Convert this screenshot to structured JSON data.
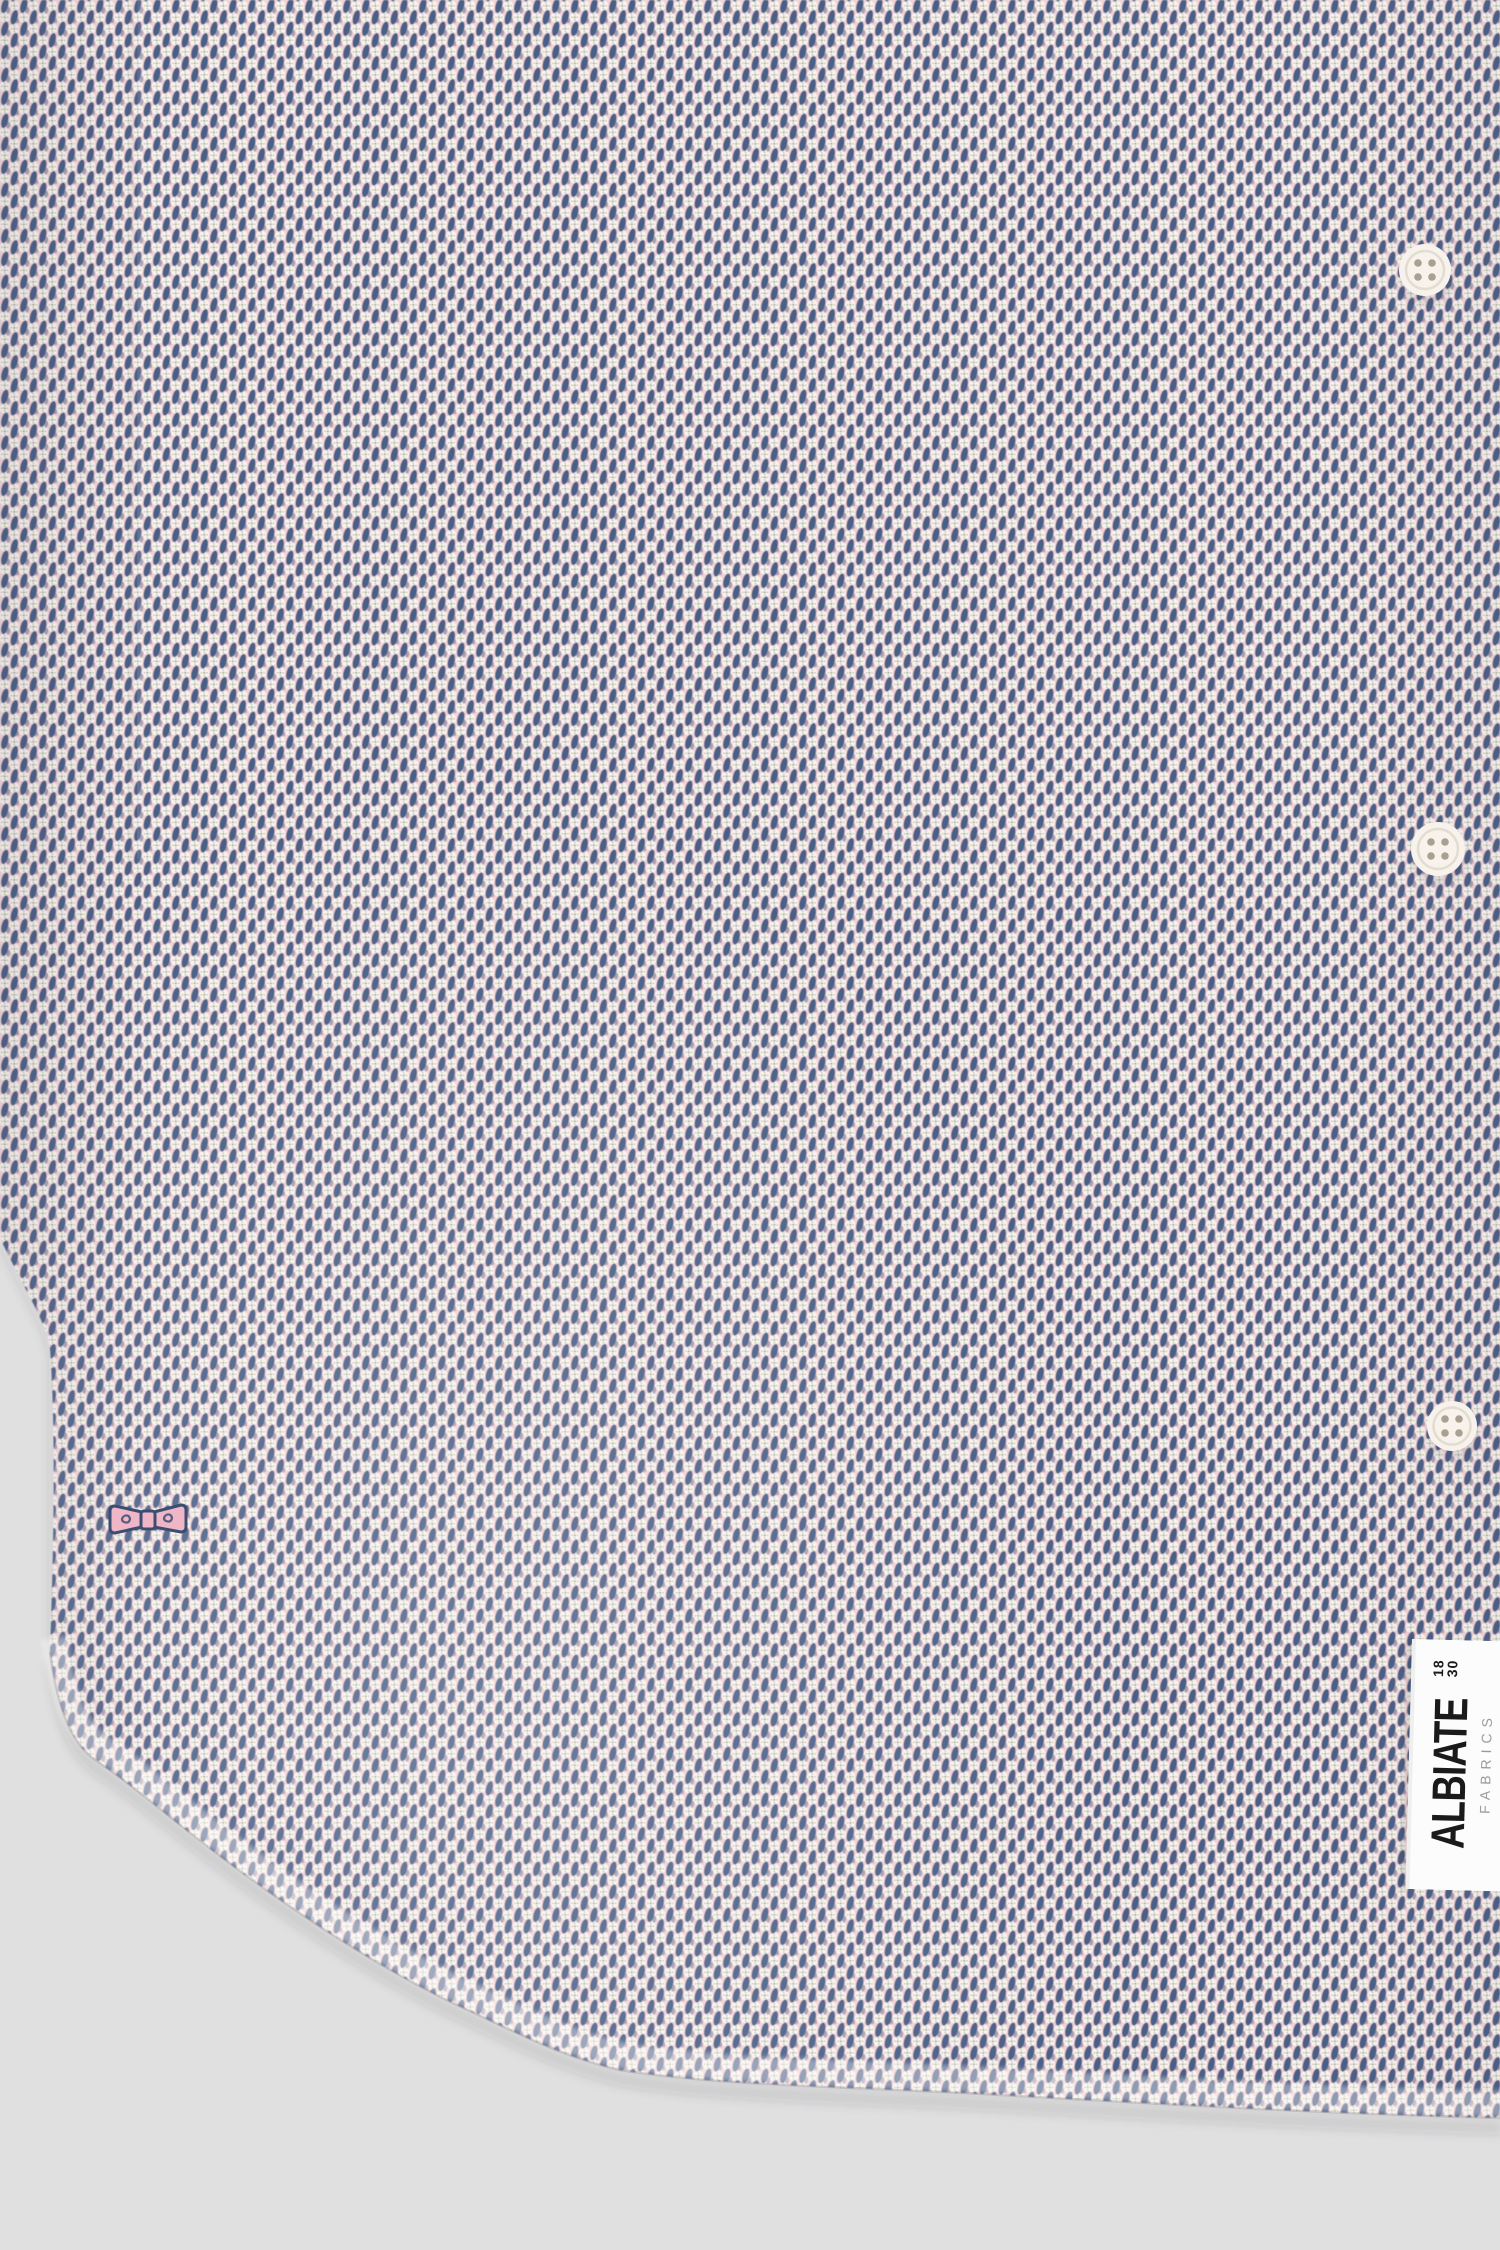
{
  "scene": {
    "description": "Close-up product photograph of the lower half of a button-up shirt in a pink, white and navy micro-diamond print, showing three buttons, an embroidered bow logo and a woven ALBIATE FABRICS side label over a light grey studio background",
    "background_color": "#e0e0e1"
  },
  "fabric": {
    "pattern": "diagonal micro diamond / dot print",
    "colors": {
      "pink": "#f3d2d5",
      "white": "#f9f5f1",
      "navy": "#4a5f86",
      "dot": "#9da188"
    }
  },
  "buttons": {
    "count": 3,
    "color": "#f7f3ec",
    "hole_color": "#aaa091",
    "rim_color": "#d8d1c6"
  },
  "bow_logo": {
    "fill": "#efb6c7",
    "outline": "#3c4d72"
  },
  "label": {
    "background": "#fcfcfc",
    "brand": "ALBIATE",
    "year_top": "18",
    "year_bottom": "30",
    "subtitle": "FABRICS",
    "brand_color": "#1a1a1a",
    "subtitle_color": "#9b9b9b"
  }
}
